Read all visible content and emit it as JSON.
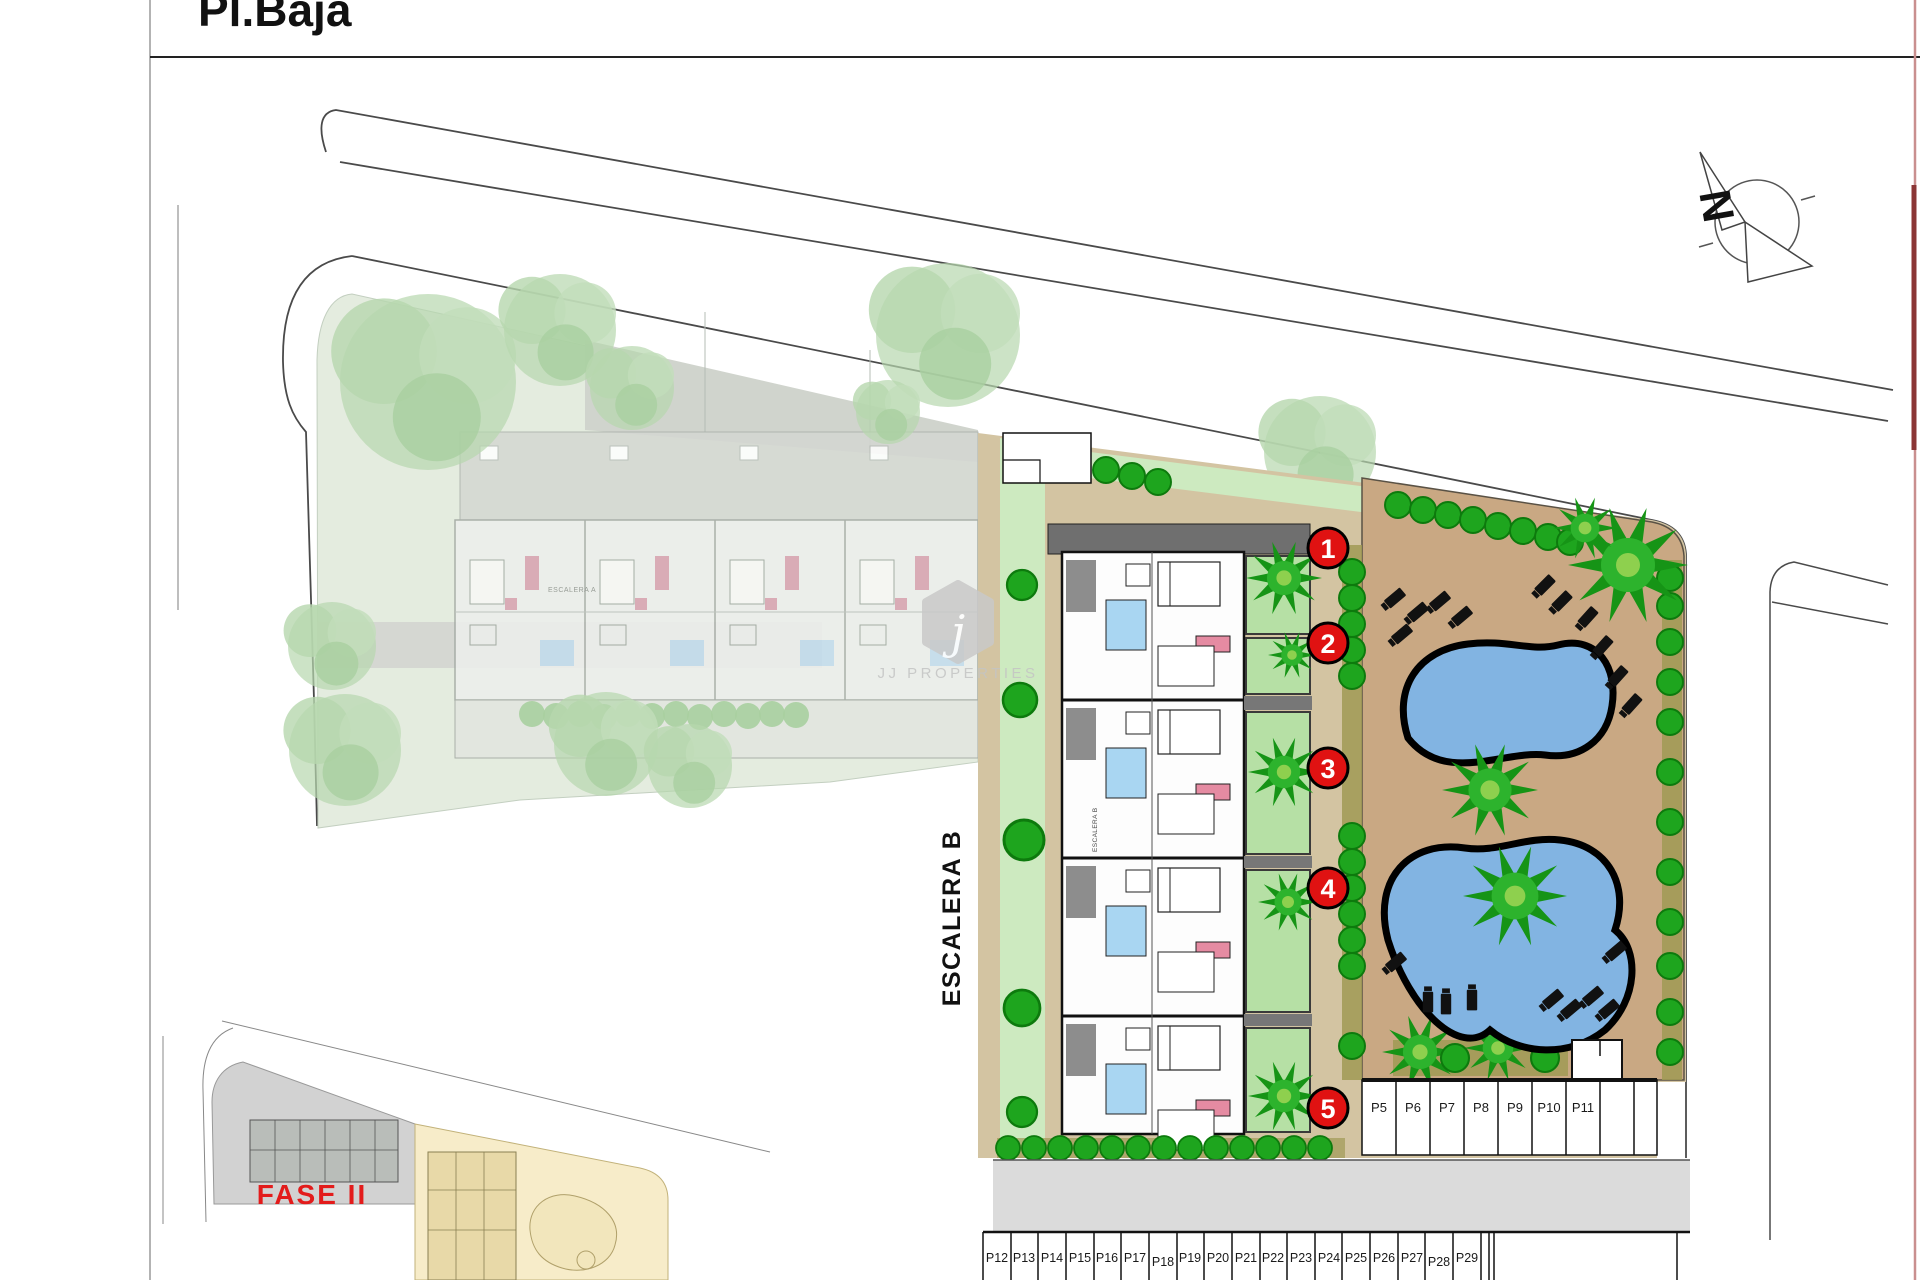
{
  "page": {
    "title": "Pl.Baja"
  },
  "compass": {
    "north_label": "N"
  },
  "labels": {
    "escalera_b": "ESCALERA B",
    "escalera_a": "ESCALERA A",
    "escalera_b_inner": "ESCALERA B",
    "fase2": "FASE II"
  },
  "watermark": {
    "logo_letter": "j",
    "brand": "JJ PROPERTIES"
  },
  "unit_markers": [
    "1",
    "2",
    "3",
    "4",
    "5"
  ],
  "parking": {
    "row_upper": [
      "P5",
      "P6",
      "P7",
      "P8",
      "P9",
      "P10",
      "P11"
    ],
    "row_lower": [
      "P12",
      "P13",
      "P14",
      "P15",
      "P16",
      "P17",
      "P18",
      "P19",
      "P20",
      "P21",
      "P22",
      "P23",
      "P24",
      "P25",
      "P26",
      "P27",
      "P28",
      "P29"
    ]
  },
  "colors": {
    "marker_red": "#e01212",
    "fase2_red": "#e31b1b",
    "pool_blue": "#82b4e2",
    "deck_tan": "#c9a883",
    "site_tan": "#d3c4a2",
    "lawn_green": "#cdeac0",
    "terrace_green": "#b6e0a5",
    "bush_green": "#1ea51e",
    "faded_site_green": "#e4ecdf",
    "faded_tree_green": "#b7d7ae",
    "road_gray": "#dbdbdb",
    "page_border_pink": "#c98f8f"
  }
}
